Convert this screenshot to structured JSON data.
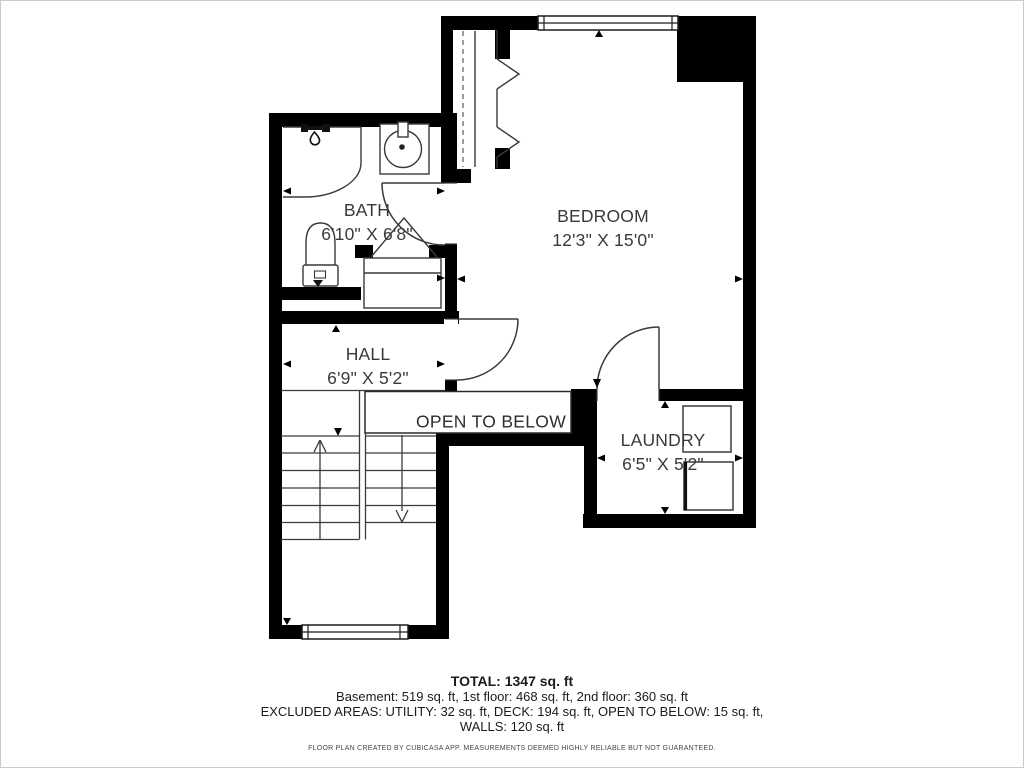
{
  "plan": {
    "rooms": [
      {
        "id": "bath",
        "name": "BATH",
        "dims": "6'10\" X 6'8\""
      },
      {
        "id": "bedroom",
        "name": "BEDROOM",
        "dims": "12'3\" X 15'0\""
      },
      {
        "id": "hall",
        "name": "HALL",
        "dims": "6'9\" X 5'2\""
      },
      {
        "id": "laundry",
        "name": "LAUNDRY",
        "dims": "6'5\" X 5'2\""
      }
    ],
    "open_to_below_label": "OPEN TO BELOW",
    "icons": [
      "shower-icon",
      "sink-icon",
      "toilet-icon",
      "washer-icon",
      "dryer-icon",
      "bifold-door-icon",
      "stairs-up-arrow",
      "stairs-down-arrow",
      "window-icon",
      "door-swing-icon"
    ],
    "colors": {
      "wall": "#000000",
      "line": "#3a3a3a",
      "label_text": "#3a3a3a",
      "summary_text": "#1b1b1b"
    }
  },
  "summary": {
    "total": "TOTAL: 1347 sq. ft",
    "floors": "Basement: 519 sq. ft, 1st floor: 468 sq. ft, 2nd floor: 360 sq. ft",
    "excluded": "EXCLUDED AREAS: UTILITY: 32 sq. ft, DECK: 194 sq. ft, OPEN TO BELOW: 15 sq. ft,",
    "walls": "WALLS: 120 sq. ft",
    "footer": "FLOOR PLAN CREATED BY CUBICASA APP. MEASUREMENTS DEEMED HIGHLY RELIABLE BUT NOT GUARANTEED."
  }
}
